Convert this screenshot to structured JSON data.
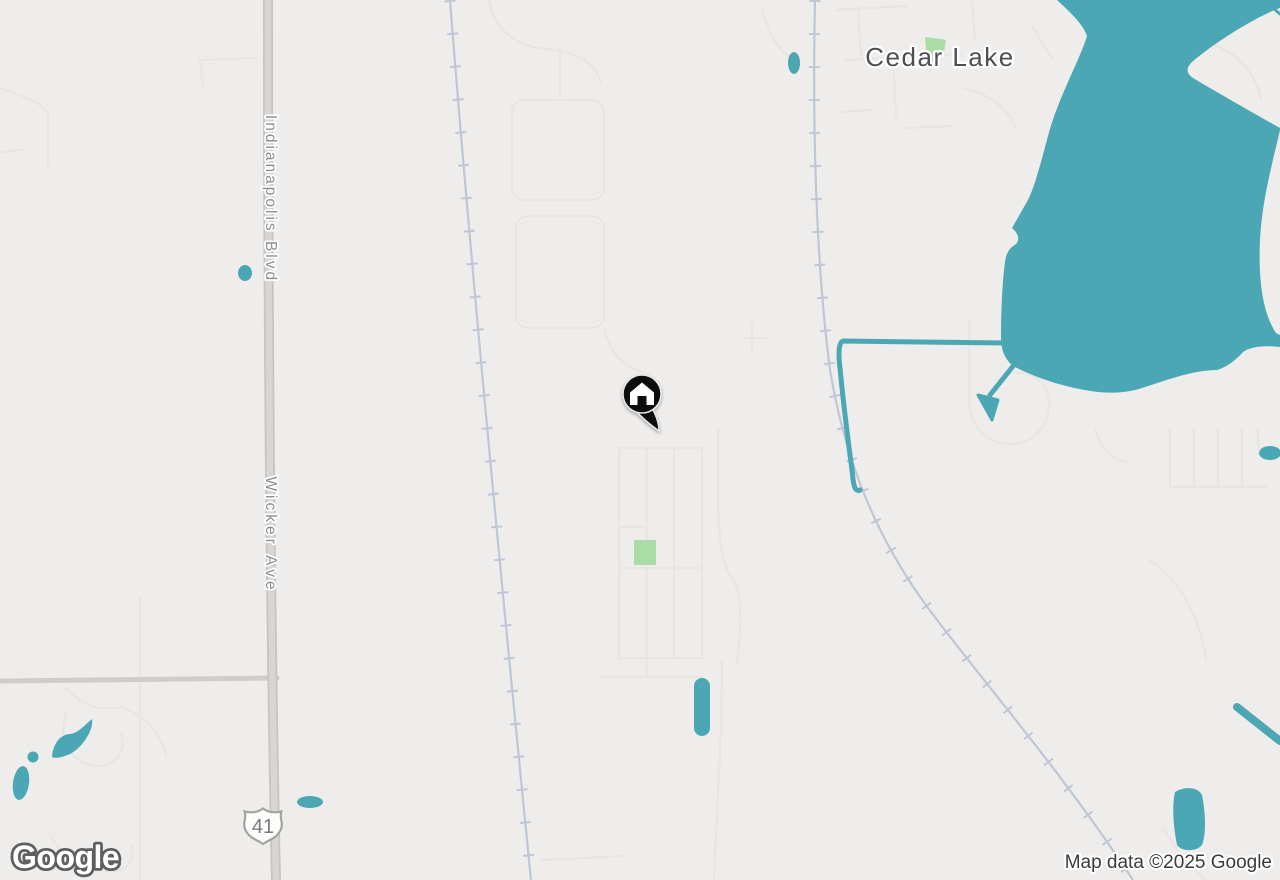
{
  "map_view": {
    "place_label": "Cedar Lake",
    "road_labels": {
      "north_segment": "Indianapolis Blvd",
      "south_segment": "Wicker Ave"
    },
    "route_shield": {
      "system": "US Route",
      "number": "41"
    },
    "marker": {
      "type": "home",
      "color": "#0B0B0B"
    },
    "attribution": {
      "logo_text": "Google",
      "text": "Map data ©2025 Google"
    },
    "colors": {
      "water": "#4BA7B4",
      "land": "#EFEDEB",
      "park": "#ABDBA6",
      "road_major": "#D2D0CE",
      "road_minor": "#E8E5E3",
      "railroad": "#BFC6D6",
      "label_town": "#4F4F52",
      "label_road": "#8F8E8D",
      "attribution_text": "#3B3B3D"
    }
  }
}
